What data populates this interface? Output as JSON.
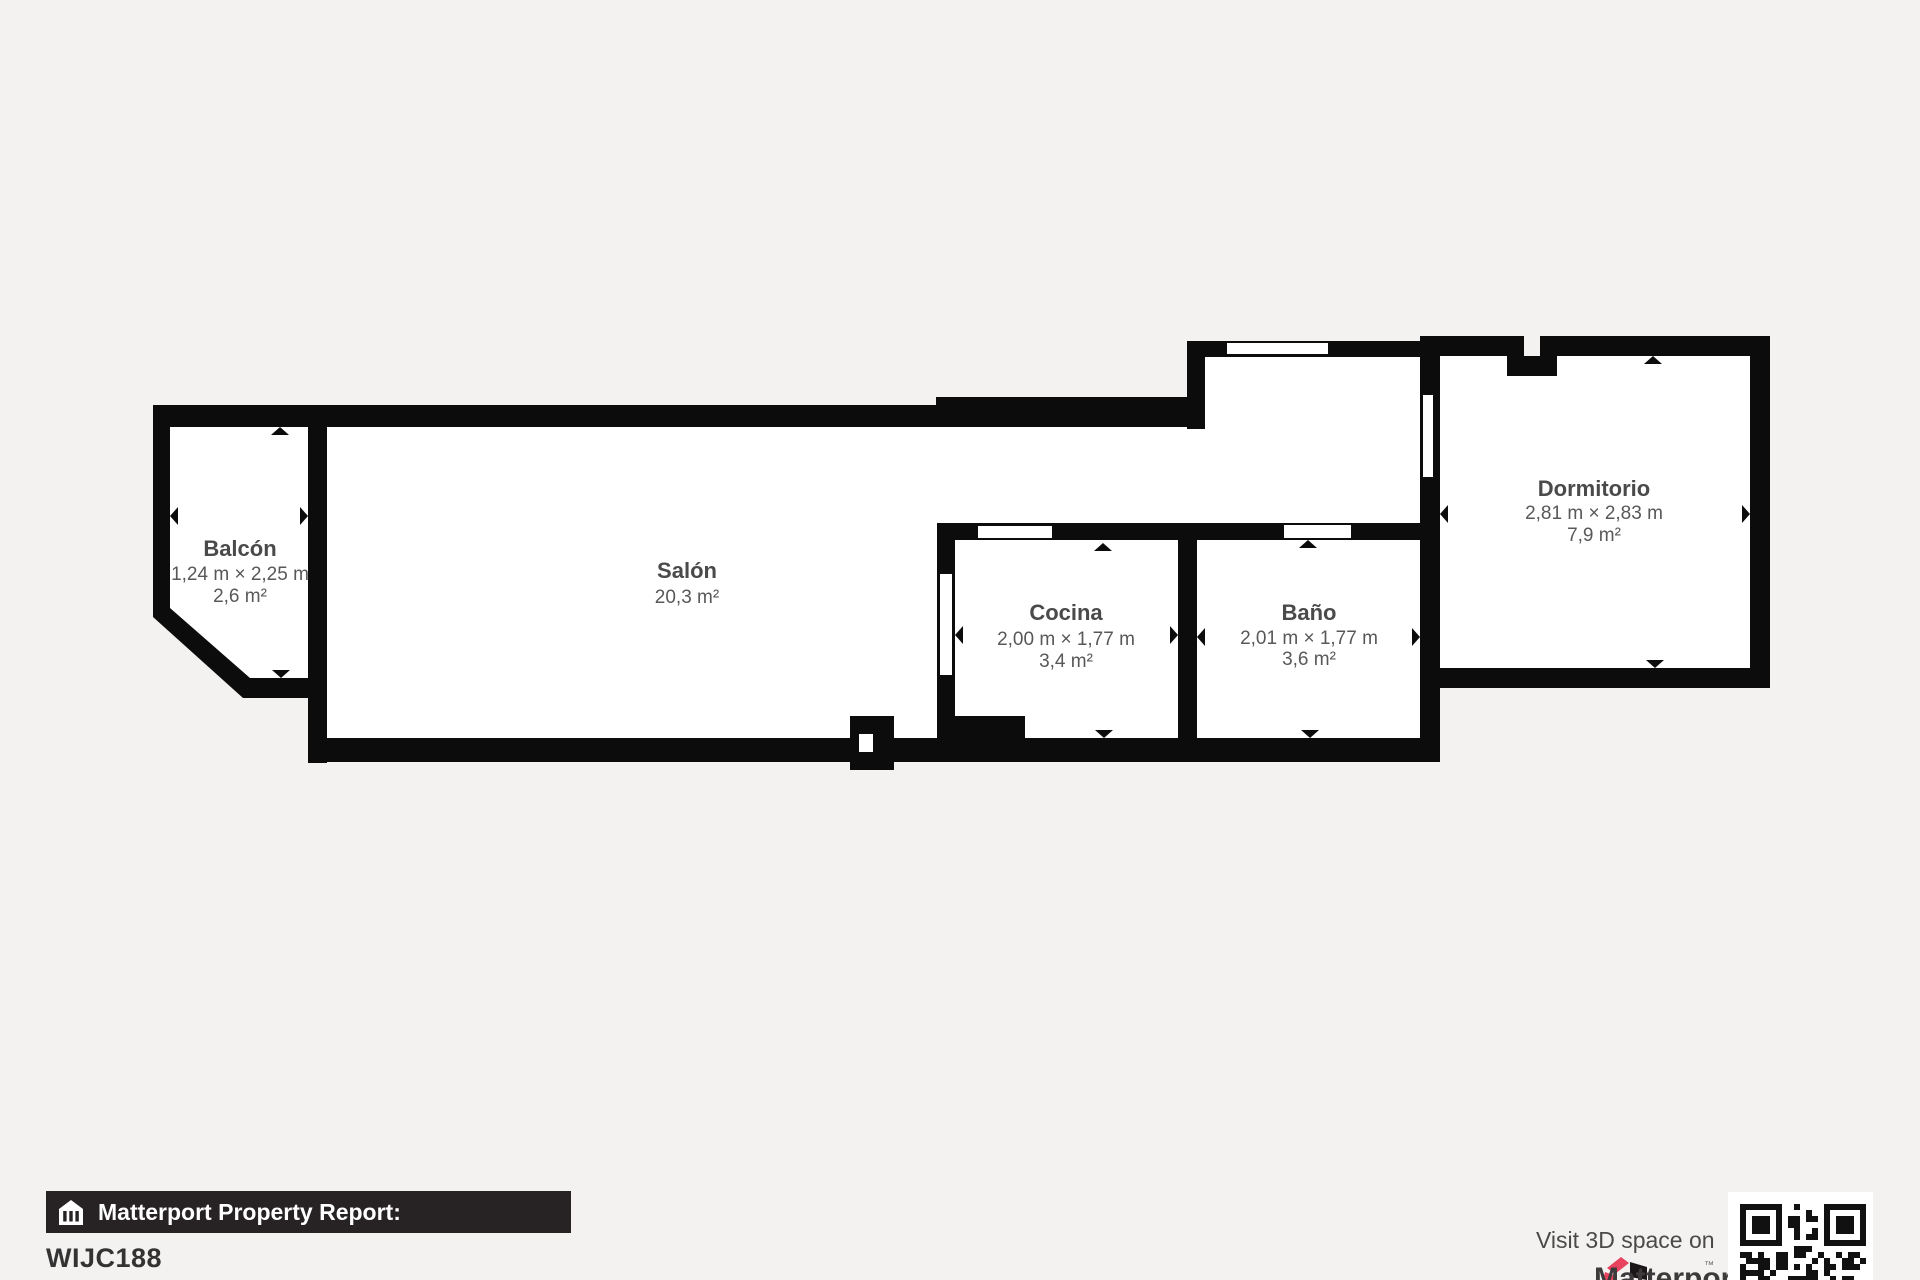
{
  "page": {
    "background_color": "#f4f2f0",
    "floor_color": "#ffffff",
    "wall_color": "#0c0c0c",
    "label_color": "#4a4a4a",
    "dim_color": "#585858"
  },
  "rooms": [
    {
      "name": "Balcón",
      "dimensions": "1,24 m × 2,25 m",
      "area": "2,6 m²"
    },
    {
      "name": "Salón",
      "dimensions": "",
      "area": "20,3 m²"
    },
    {
      "name": "Cocina",
      "dimensions": "2,00 m × 1,77 m",
      "area": "3,4 m²"
    },
    {
      "name": "Baño",
      "dimensions": "2,01 m × 1,77 m",
      "area": "3,6 m²"
    },
    {
      "name": "Dormitorio",
      "dimensions": "2,81 m × 2,83 m",
      "area": "7,9 m²"
    }
  ],
  "footer": {
    "report_label": "Matterport Property Report:",
    "property_id": "WIJC188",
    "visit_label": "Visit 3D space on",
    "brand_name": "Matterport",
    "banner_bg": "#272324",
    "brand_pink": "#e8435f",
    "logo_icon": "matterport-logo",
    "qr_icon": "qr-code"
  }
}
